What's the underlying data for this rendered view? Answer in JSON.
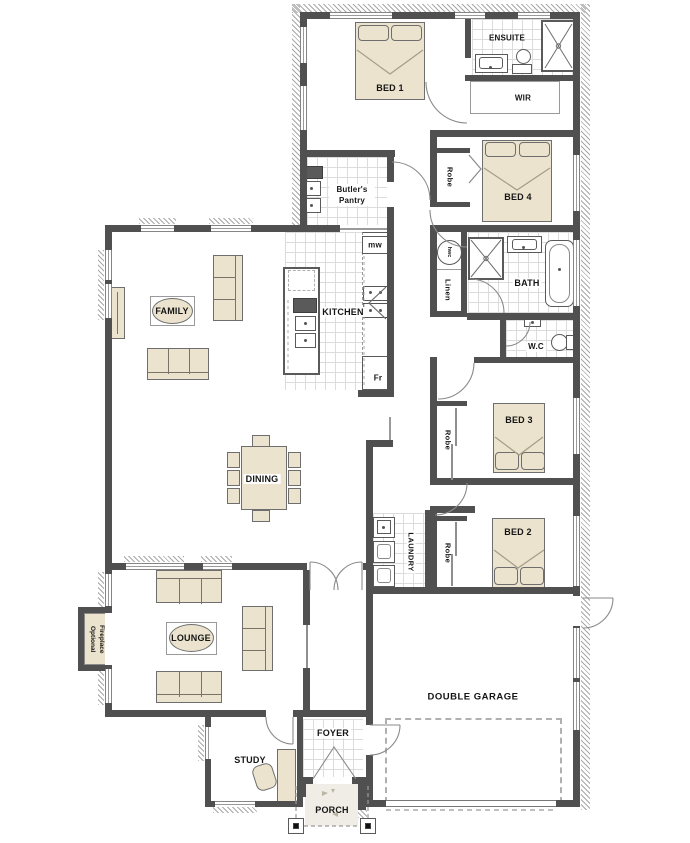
{
  "title": "Single storey house floor plan",
  "colors": {
    "wall": "#505050",
    "furniture": "#ebe3cd",
    "tile_line": "#dcdcdc",
    "hatch": "#a8a8a8"
  },
  "rooms": {
    "bed1": "BED 1",
    "ensuite": "ENSUITE",
    "wir": "WIR",
    "bed4": "BED 4",
    "robe": "Robe",
    "butlers_pantry": "Butler's Pantry",
    "family": "FAMILY",
    "kitchen": "KITCHEN",
    "microwave": "mw",
    "fridge": "Fr",
    "hwc": "hwc",
    "linen": "Linen",
    "bath": "BATH",
    "wc": "W.C",
    "bed3": "BED 3",
    "dining": "DINING",
    "laundry": "LAUNDRY",
    "bed2": "BED 2",
    "lounge": "LOUNGE",
    "optional_fireplace": "Optional Fireplace",
    "double_garage": "DOUBLE GARAGE",
    "study": "STUDY",
    "foyer": "FOYER",
    "porch": "PORCH"
  }
}
